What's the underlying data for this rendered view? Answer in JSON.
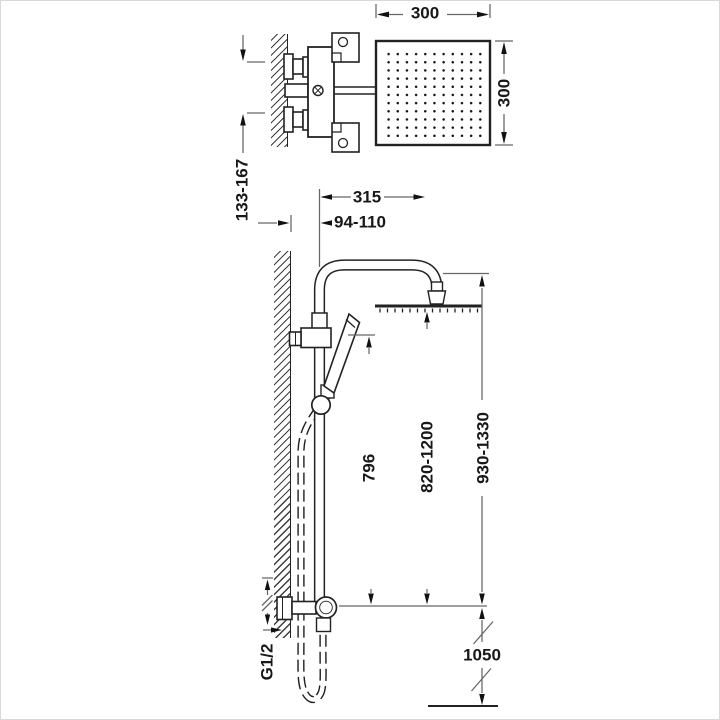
{
  "diagram": {
    "kind": "shower-column-installation-drawing",
    "labels": {
      "head_width": "300",
      "head_depth": "300",
      "inlet_spacing": "133-167",
      "arm_reach": "315",
      "wall_offset": "94-110",
      "bar_height": "796",
      "column_height": "820-1200",
      "overall_height": "930-1330",
      "supply_height": "1050",
      "thread": "G1/2"
    },
    "colors": {
      "object_line": "#222222",
      "dimension_line": "#666666",
      "text": "#181818",
      "background": "#ffffff"
    }
  }
}
